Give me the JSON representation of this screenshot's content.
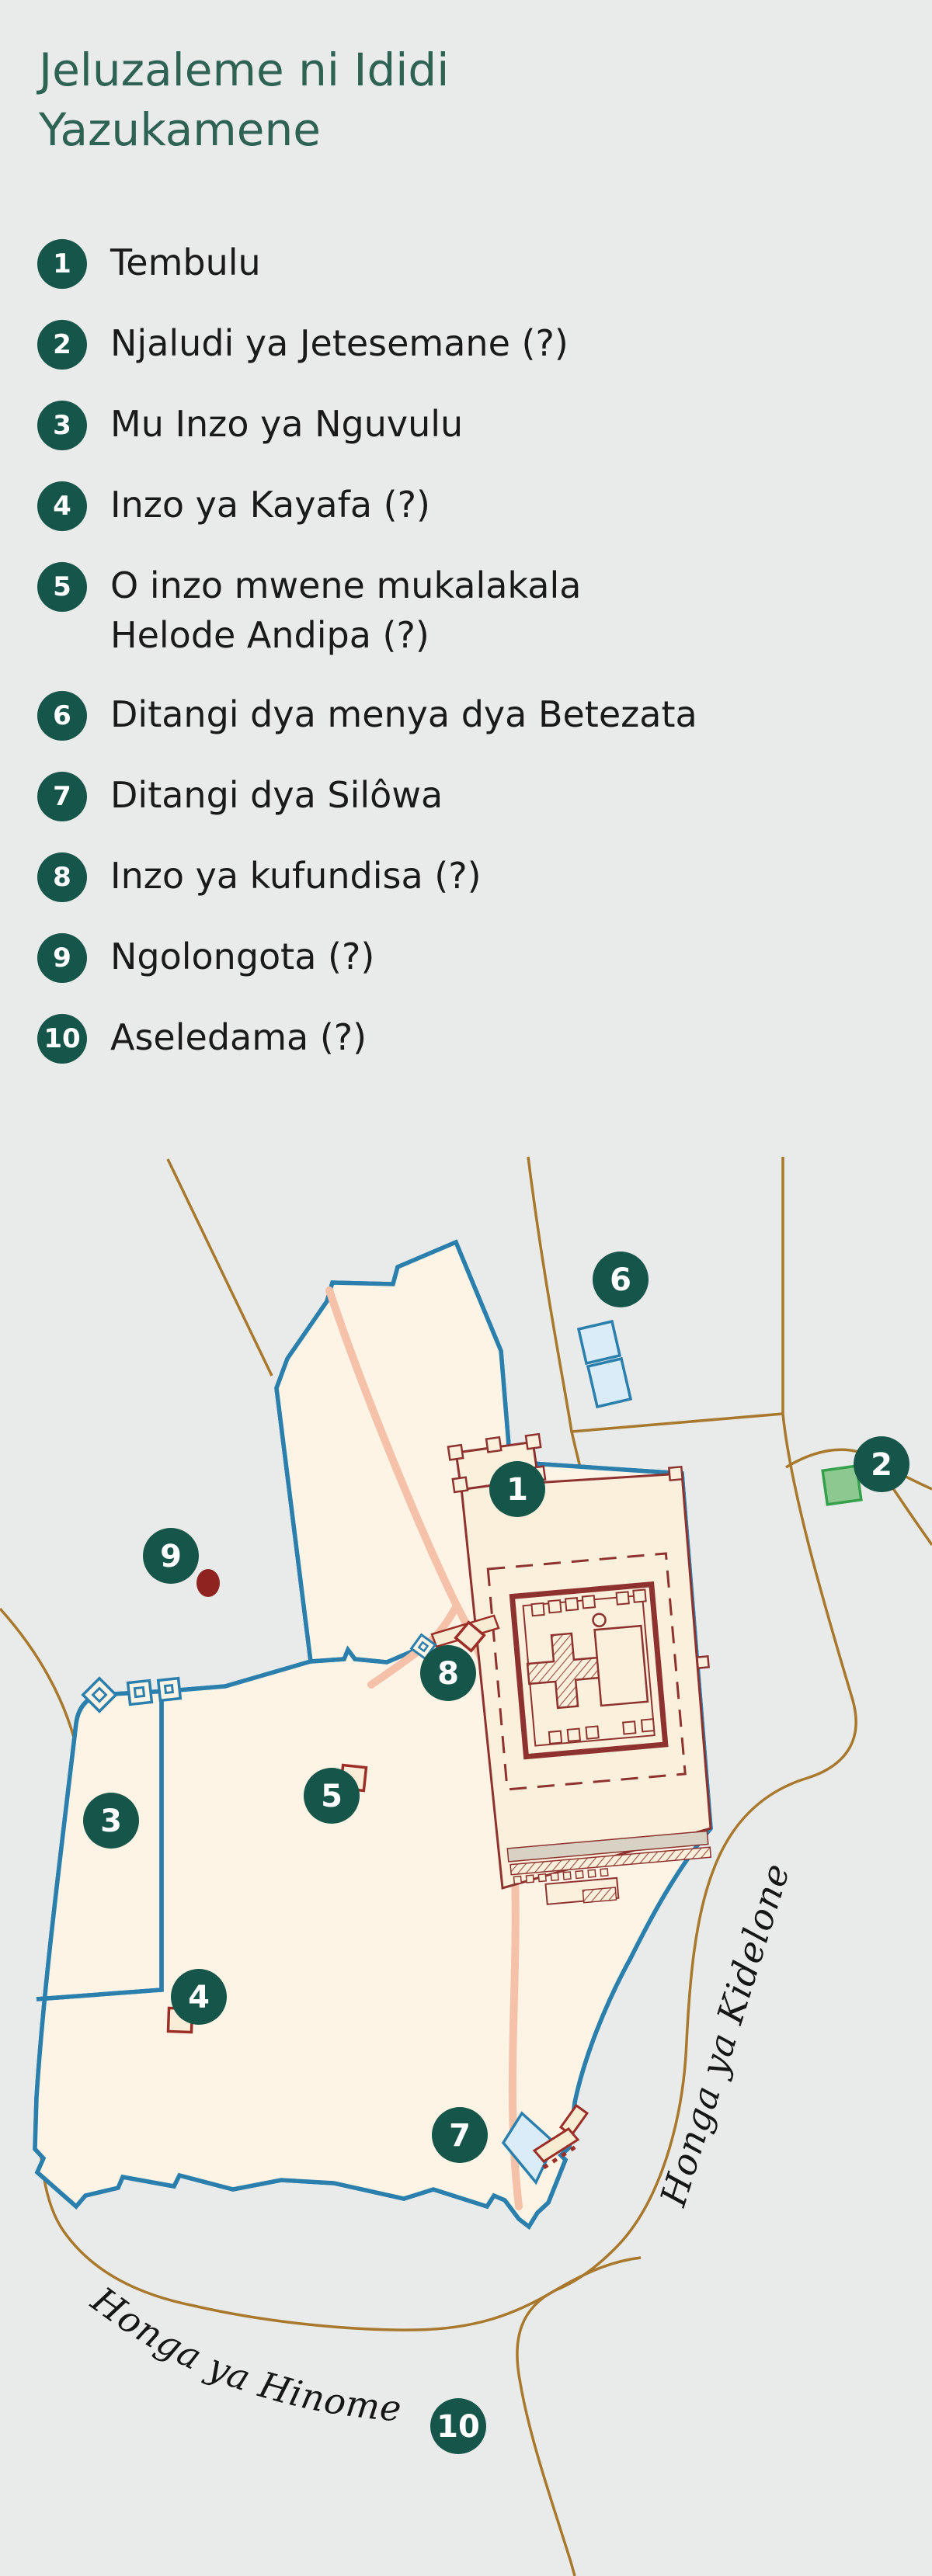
{
  "title": {
    "line1": "Jeluzaleme ni Ididi",
    "line2": "Yazukamene"
  },
  "legend": {
    "items": [
      {
        "number": "1",
        "label": "Tembulu"
      },
      {
        "number": "2",
        "label": "Njaludi ya Jetesemane (?)"
      },
      {
        "number": "3",
        "label": "Mu Inzo ya Nguvulu"
      },
      {
        "number": "4",
        "label": "Inzo ya Kayafa (?)"
      },
      {
        "number": "5",
        "label": "O inzo mwene mukalakala Helode Andipa (?)"
      },
      {
        "number": "6",
        "label": "Ditangi dya menya dya Betezata"
      },
      {
        "number": "7",
        "label": "Ditangi dya Silôwa"
      },
      {
        "number": "8",
        "label": "Inzo ya kufundisa (?)"
      },
      {
        "number": "9",
        "label": "Ngolongota (?)"
      },
      {
        "number": "10",
        "label": "Aseledama (?)"
      }
    ]
  },
  "map": {
    "road_labels": {
      "kidron": "Honga ya Kidelone",
      "hinnom": "Honga ya Hinome"
    },
    "markers": [
      {
        "number": "1"
      },
      {
        "number": "2"
      },
      {
        "number": "3"
      },
      {
        "number": "4"
      },
      {
        "number": "5"
      },
      {
        "number": "6"
      },
      {
        "number": "7"
      },
      {
        "number": "8"
      },
      {
        "number": "9"
      },
      {
        "number": "10"
      }
    ],
    "colors": {
      "background": "#e9eaea",
      "title_green": "#2e6354",
      "marker_green": "#16564a",
      "wall_blue": "#2a7fad",
      "city_fill": "#fdf4e6",
      "temple_fill": "#faf0dc",
      "temple_outline": "#8e3230",
      "road_brown": "#a8782c",
      "road_pink": "#f5c1a9",
      "pool_fill": "#d9ecf8",
      "garden_green_fill": "#8cc88f",
      "garden_green_stroke": "#36a14c",
      "golgotha_red": "#8e2320"
    }
  }
}
